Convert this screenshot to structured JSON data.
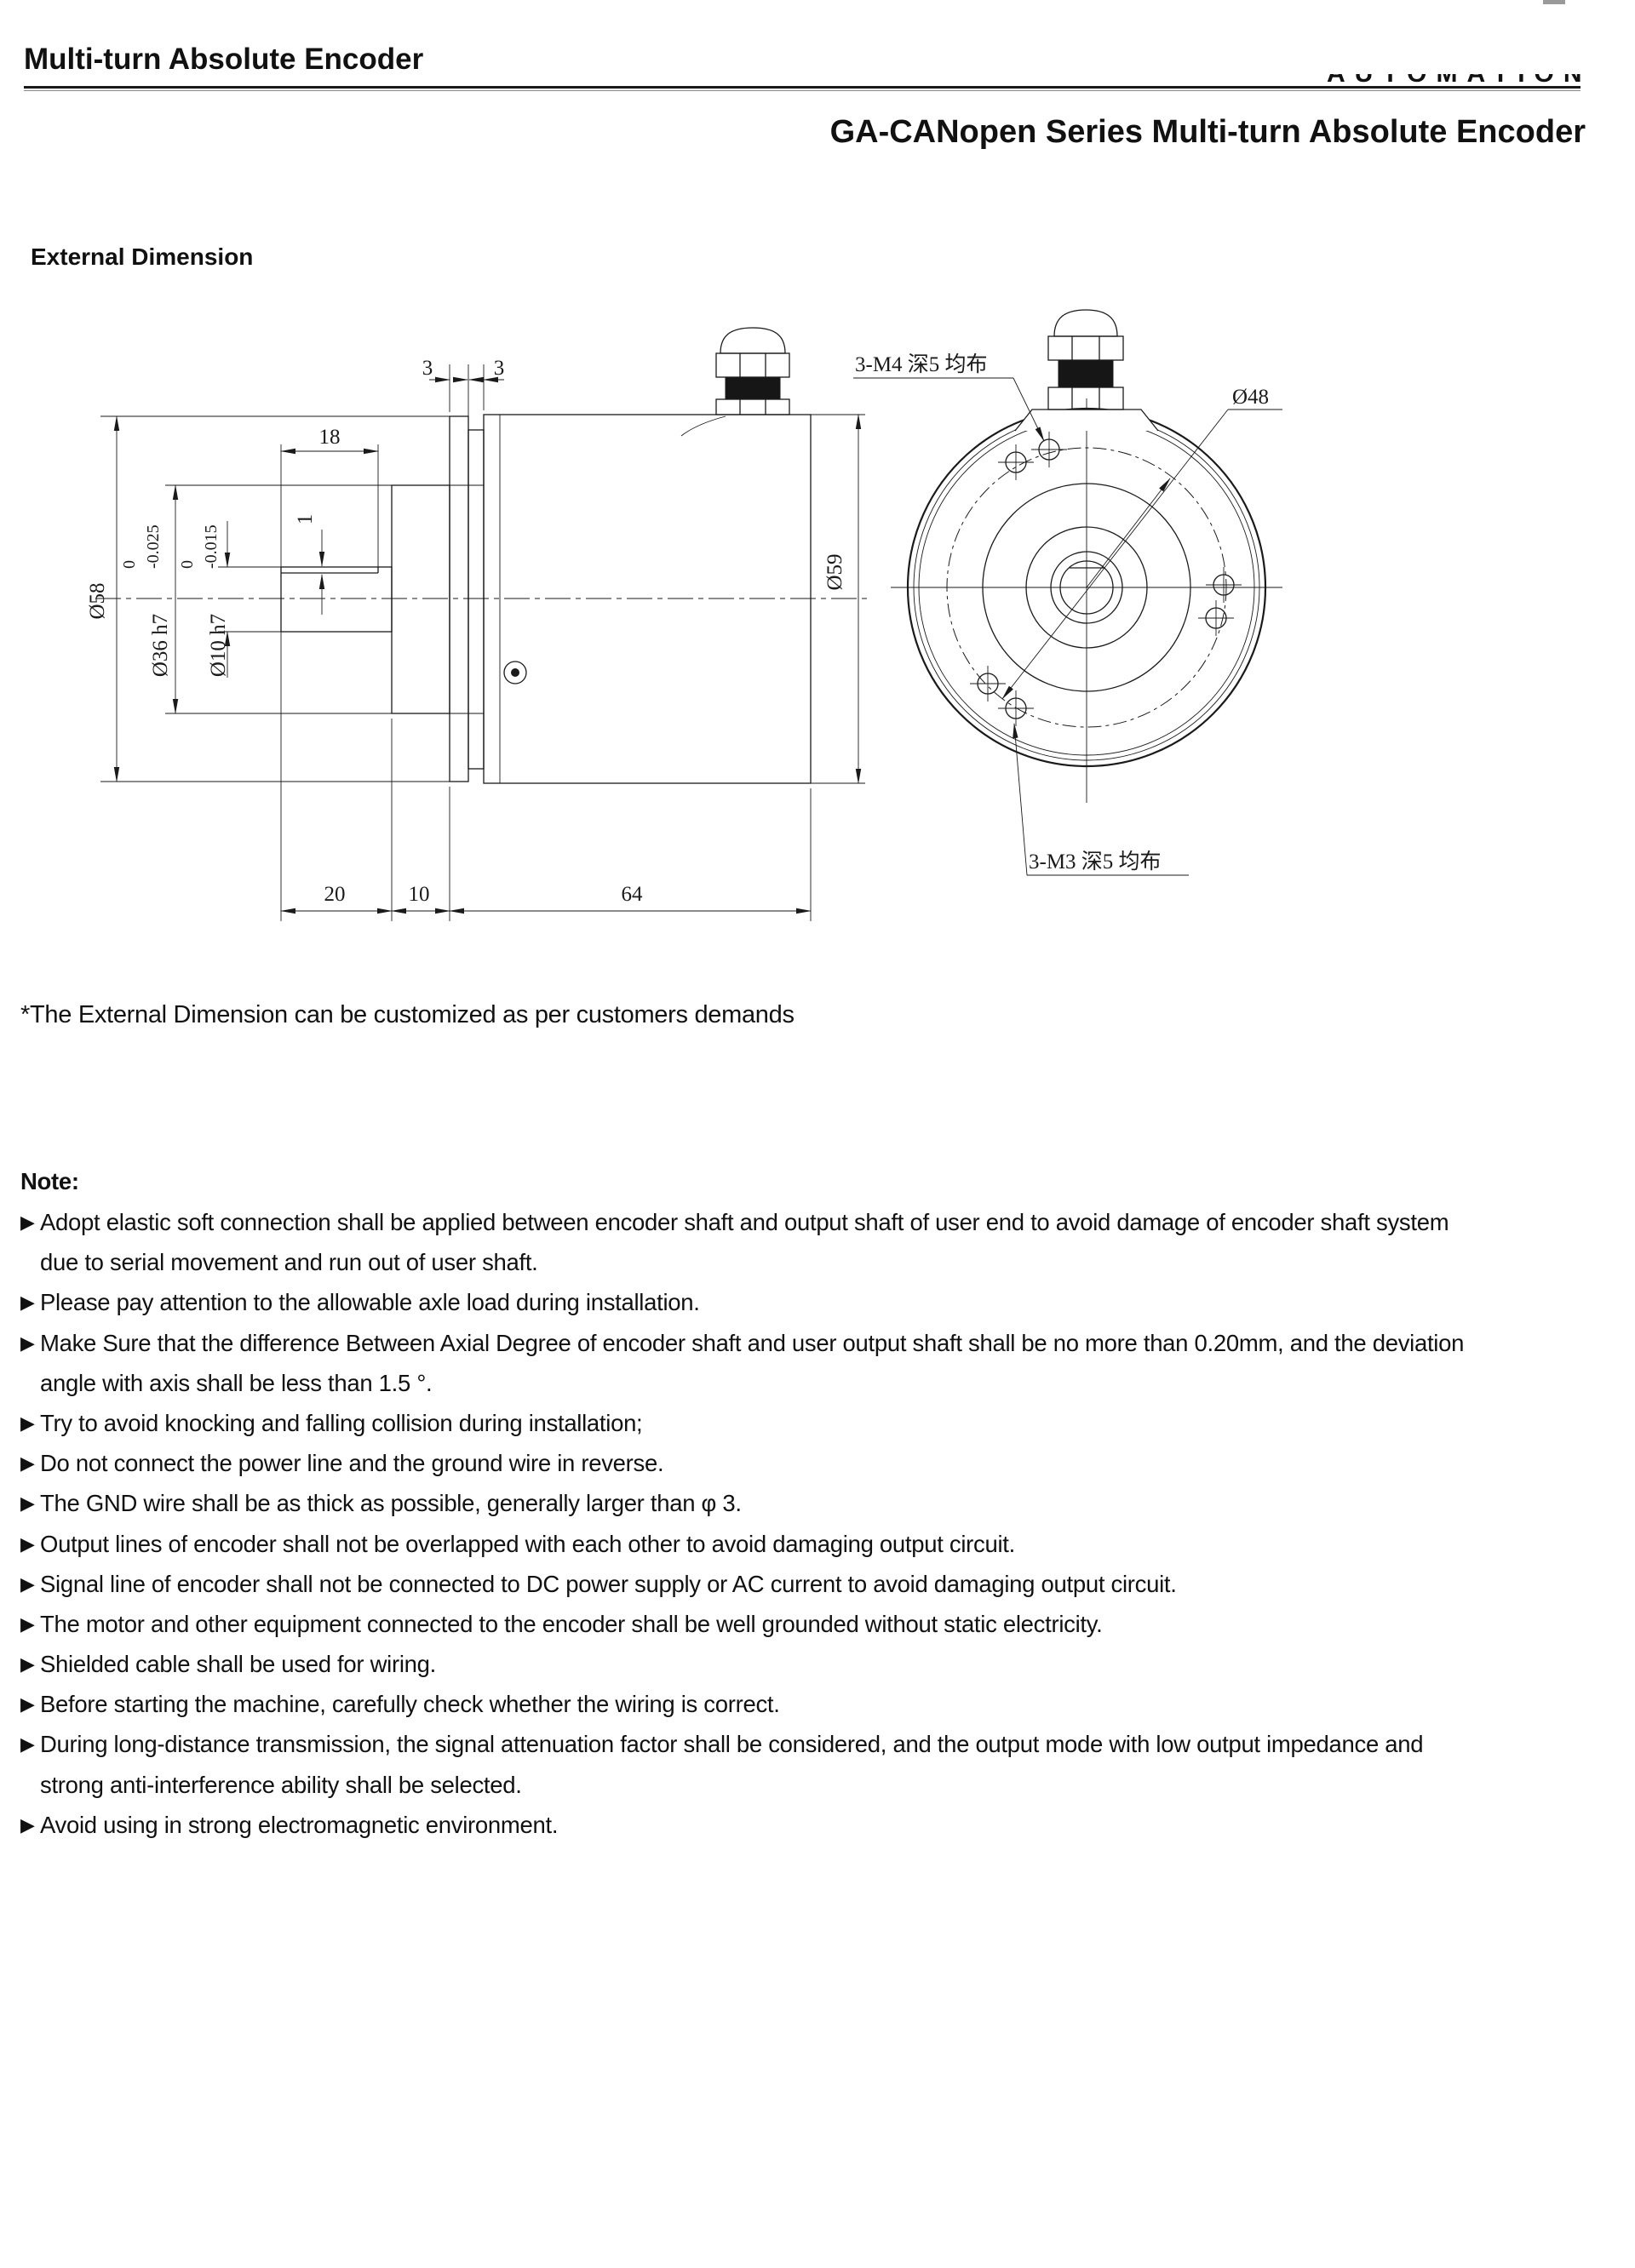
{
  "header": {
    "page_title": "Multi-turn Absolute Encoder",
    "brand_watermark": "AUTOMATION",
    "series_title": "GA-CANopen Series Multi-turn Absolute Encoder",
    "section_title": "External Dimension",
    "customize_note": "*The External Dimension can be customized as per customers demands"
  },
  "drawing": {
    "side_view": {
      "dia_58": "Ø58",
      "dia_36": "Ø36 h7",
      "dia_36_tol_upper": "0",
      "dia_36_tol_lower": "-0.025",
      "dia_10": "Ø10 h7",
      "dia_10_tol_upper": "0",
      "dia_10_tol_lower": "-0.015",
      "flat_length": "18",
      "flat_depth": "1",
      "flange_thickness_left": "3",
      "flange_thickness_right": "3",
      "dia_59": "Ø59",
      "shaft_length": "20",
      "hub_length": "10",
      "body_length": "64"
    },
    "front_view": {
      "m4_holes_callout": "3-M4 深5 均布",
      "m3_holes_callout": "3-M3 深5 均布",
      "bolt_circle_dia": "Ø48"
    }
  },
  "notes": {
    "heading": "Note:",
    "bullet": "▶",
    "items": [
      {
        "lines": [
          "Adopt elastic soft connection shall be applied between encoder shaft and output shaft of user end to avoid damage of encoder shaft system",
          "due to serial movement and run out of user shaft."
        ]
      },
      {
        "lines": [
          "Please pay attention to the allowable axle load during installation."
        ]
      },
      {
        "lines": [
          "Make Sure that the difference Between Axial Degree of encoder shaft and user output shaft shall be no more than 0.20mm, and the deviation",
          "angle with axis shall be less than 1.5 °."
        ]
      },
      {
        "lines": [
          "Try to avoid knocking and falling collision during installation;"
        ]
      },
      {
        "lines": [
          "Do not connect the power line and the ground wire in reverse."
        ]
      },
      {
        "lines": [
          "The GND wire shall be as thick as possible, generally larger than φ 3."
        ]
      },
      {
        "lines": [
          "Output lines of encoder shall not be overlapped with each other to avoid damaging output circuit."
        ]
      },
      {
        "lines": [
          "Signal line of encoder shall not be connected to DC power supply or AC current to avoid damaging output circuit."
        ]
      },
      {
        "lines": [
          "The motor and other equipment connected to the encoder shall be well grounded without static electricity."
        ]
      },
      {
        "lines": [
          "Shielded cable shall be used for wiring."
        ]
      },
      {
        "lines": [
          "Before starting the machine, carefully check whether the wiring is correct."
        ]
      },
      {
        "lines": [
          "During long-distance transmission, the signal attenuation factor shall be considered, and the output mode with low output impedance and",
          "strong anti-interference ability shall be selected."
        ]
      },
      {
        "lines": [
          "Avoid using in strong electromagnetic environment."
        ]
      }
    ]
  }
}
